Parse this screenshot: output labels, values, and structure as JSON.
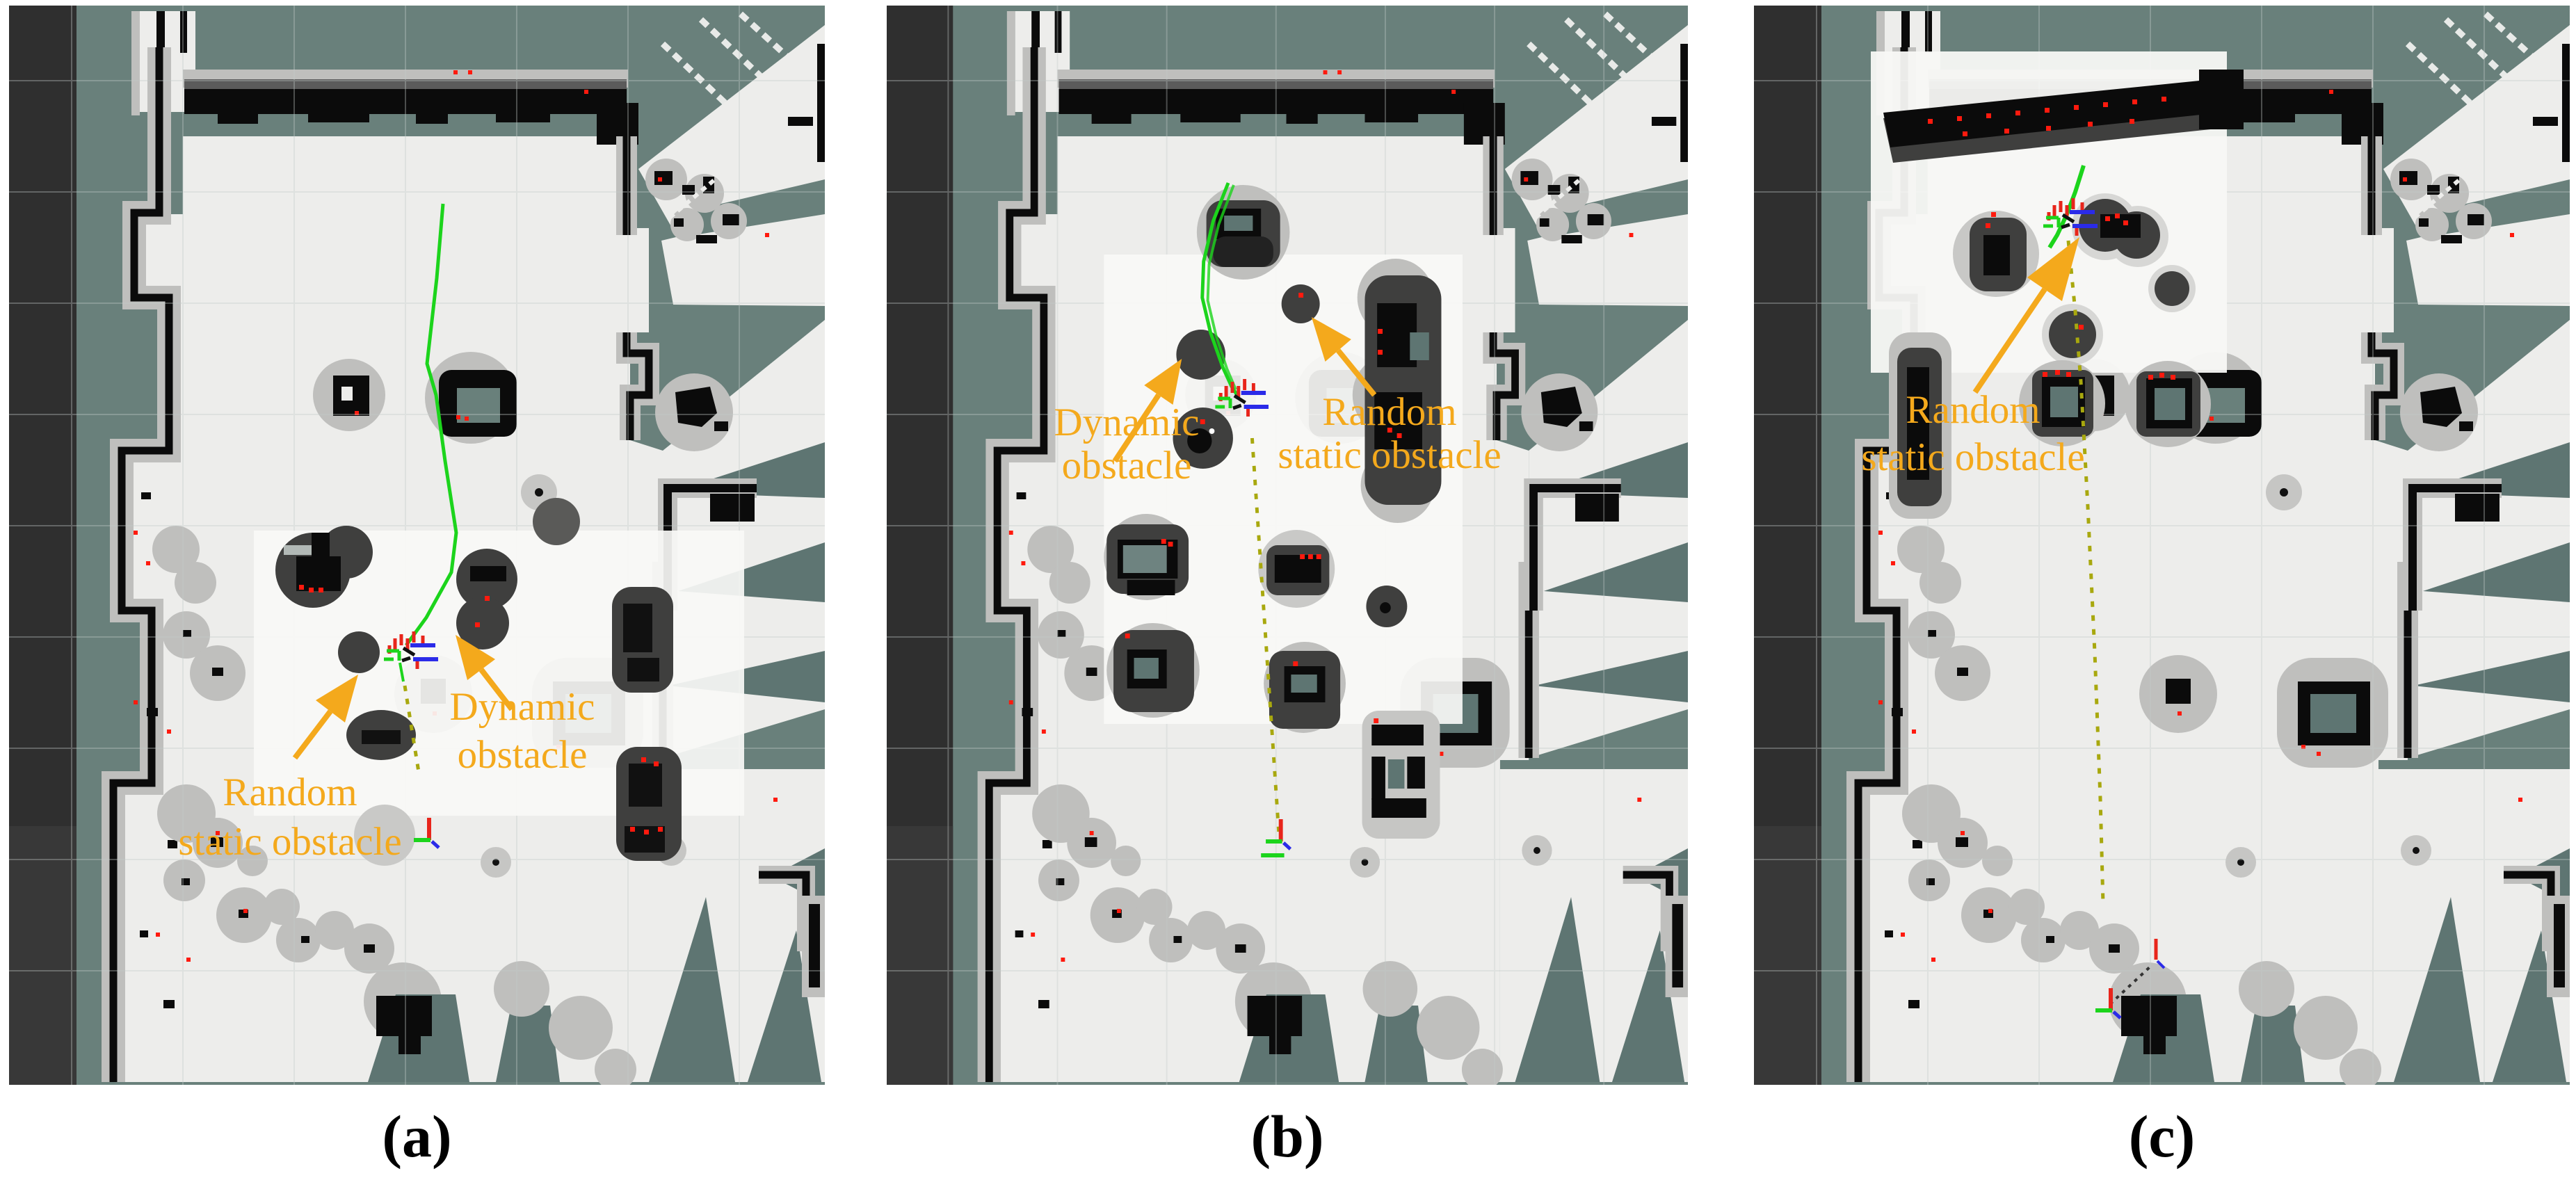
{
  "figure": {
    "panels": [
      {
        "id": "a",
        "caption": "(a)",
        "annotations": [
          {
            "name": "random-static-obstacle-label",
            "lines": [
              "Random",
              "static obstacle"
            ]
          },
          {
            "name": "dynamic-obstacle-label",
            "lines": [
              "Dynamic",
              "obstacle"
            ]
          }
        ]
      },
      {
        "id": "b",
        "caption": "(b)",
        "annotations": [
          {
            "name": "dynamic-obstacle-label",
            "lines": [
              "Dynamic",
              "obstacle"
            ]
          },
          {
            "name": "random-static-obstacle-label",
            "lines": [
              "Random",
              "static obstacle"
            ]
          }
        ]
      },
      {
        "id": "c",
        "caption": "(c)",
        "annotations": [
          {
            "name": "random-static-obstacle-label",
            "lines": [
              "Random",
              "static obstacle"
            ]
          }
        ]
      }
    ],
    "glyphs": {
      "robot_pose": "rgb-axes-cluster",
      "goal_pose": "red-green-axes-marker",
      "annotation_arrow": "solid-orange-arrow",
      "global_path": "green-polyline",
      "planned_path": "yellow-dashed-line",
      "laser_hits": "red-dot-speckles",
      "grid": "faint-gray-grid"
    },
    "colors": {
      "annotation_orange": "#F4A91C",
      "unknown_space_teal": "#69807B",
      "free_space_gray": "#EDEDEB",
      "local_costmap_white": "#F8F8F6",
      "inflation_gray": "#BFBFBD",
      "occupied_black": "#0B0B0B",
      "obstacle_dark_gray": "#3F3F3E",
      "global_path_green": "#1CD41C",
      "local_plan_yellow": "#A8A80E",
      "laser_scan_red": "#FF1A0E",
      "axis_blue": "#2B2BE8",
      "viewport_bar_charcoal": "#2F2F2F",
      "caption_black": "#000000"
    }
  }
}
